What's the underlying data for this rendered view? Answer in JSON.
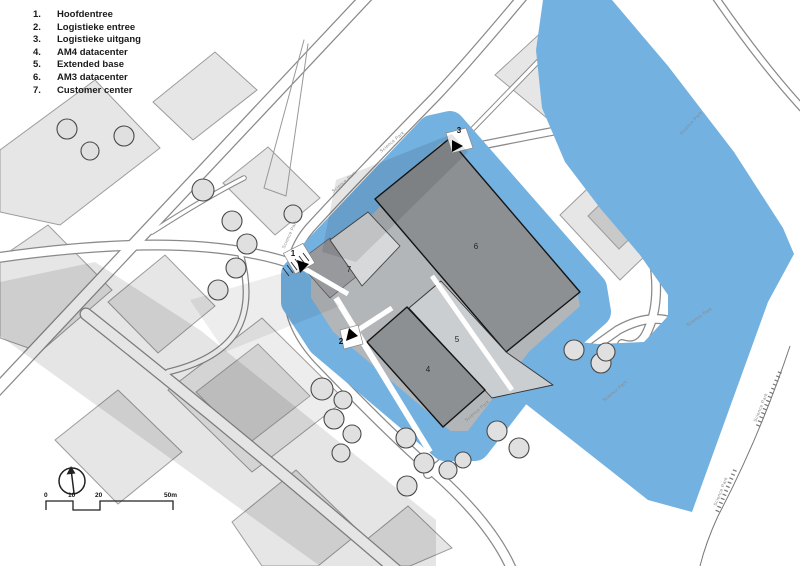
{
  "legend": {
    "items": [
      {
        "num": "1.",
        "label": "Hoofdentree"
      },
      {
        "num": "2.",
        "label": "Logistieke entree"
      },
      {
        "num": "3.",
        "label": "Logistieke uitgang"
      },
      {
        "num": "4.",
        "label": "AM4 datacenter"
      },
      {
        "num": "5.",
        "label": "Extended base"
      },
      {
        "num": "6.",
        "label": "AM3 datacenter"
      },
      {
        "num": "7.",
        "label": "Customer center"
      }
    ]
  },
  "map": {
    "building_labels": {
      "b4": "4",
      "b5": "5",
      "b6": "6",
      "b7": "7"
    },
    "markers": {
      "m1": "1",
      "m2": "2",
      "m3": "3"
    },
    "street_label": "Science Park",
    "colors": {
      "water": "#73b1e1",
      "building_dark": "#8d9092",
      "building_light_island": "#cbced0",
      "building_offsite": "#e4e4e4",
      "island_base": "#b3b6b8",
      "road_casing": "#8a8a8a",
      "shadow": "rgba(0,0,0,0.10)"
    }
  },
  "scalebar": {
    "ticks": [
      "0",
      "10",
      "20",
      "50m"
    ]
  }
}
